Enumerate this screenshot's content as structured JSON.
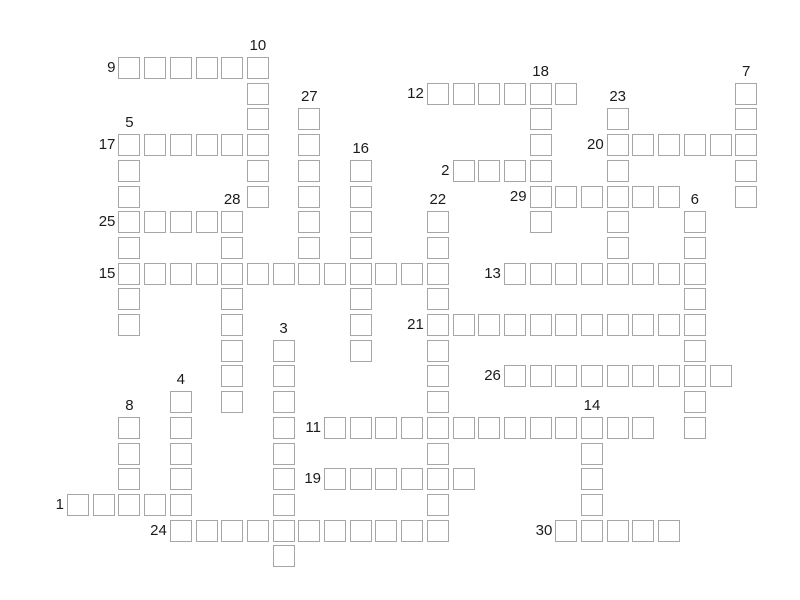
{
  "page": {
    "background_color": "#ffffff",
    "grid_line_color": "#a6a6a6",
    "number_color": "#1b1b1b"
  },
  "puzzle": {
    "type": "crossword",
    "grid": {
      "page_width": 800,
      "origin_x": 67,
      "origin_y": 57,
      "pitch": 25.7,
      "cell_outer": 22,
      "cell_fill": "#ffffff",
      "cell_border_color": "#a6a6a6"
    },
    "runs": [
      {
        "number": "1",
        "dir": "across",
        "col": 0,
        "row": 17,
        "len": 5
      },
      {
        "number": "2",
        "dir": "across",
        "col": 15,
        "row": 4,
        "len": 4
      },
      {
        "number": "3",
        "dir": "down",
        "col": 8,
        "row": 11,
        "len": 9
      },
      {
        "number": "4",
        "dir": "down",
        "col": 4,
        "row": 13,
        "len": 6
      },
      {
        "number": "5",
        "dir": "down",
        "col": 2,
        "row": 3,
        "len": 8
      },
      {
        "number": "6",
        "dir": "down",
        "col": 24,
        "row": 6,
        "len": 9
      },
      {
        "number": "7",
        "dir": "down",
        "col": 26,
        "row": 1,
        "len": 5
      },
      {
        "number": "8",
        "dir": "down",
        "col": 2,
        "row": 14,
        "len": 4
      },
      {
        "number": "9",
        "dir": "across",
        "col": 2,
        "row": 0,
        "len": 6
      },
      {
        "number": "10",
        "dir": "down",
        "col": 7,
        "row": 0,
        "len": 6
      },
      {
        "number": "11",
        "dir": "across",
        "col": 10,
        "row": 14,
        "len": 13
      },
      {
        "number": "12",
        "dir": "across",
        "col": 14,
        "row": 1,
        "len": 6
      },
      {
        "number": "13",
        "dir": "across",
        "col": 17,
        "row": 8,
        "len": 8
      },
      {
        "number": "14",
        "dir": "down",
        "col": 20,
        "row": 14,
        "len": 5
      },
      {
        "number": "15",
        "dir": "across",
        "col": 2,
        "row": 8,
        "len": 13
      },
      {
        "number": "16",
        "dir": "down",
        "col": 11,
        "row": 4,
        "len": 8
      },
      {
        "number": "17",
        "dir": "across",
        "col": 2,
        "row": 3,
        "len": 6
      },
      {
        "number": "18",
        "dir": "down",
        "col": 18,
        "row": 1,
        "len": 6
      },
      {
        "number": "19",
        "dir": "across",
        "col": 10,
        "row": 16,
        "len": 6
      },
      {
        "number": "20",
        "dir": "across",
        "col": 21,
        "row": 3,
        "len": 6
      },
      {
        "number": "21",
        "dir": "across",
        "col": 14,
        "row": 10,
        "len": 11
      },
      {
        "number": "22",
        "dir": "down",
        "col": 14,
        "row": 6,
        "len": 13
      },
      {
        "number": "23",
        "dir": "down",
        "col": 21,
        "row": 2,
        "len": 7
      },
      {
        "number": "24",
        "dir": "across",
        "col": 4,
        "row": 18,
        "len": 11
      },
      {
        "number": "25",
        "dir": "across",
        "col": 2,
        "row": 6,
        "len": 5
      },
      {
        "number": "26",
        "dir": "across",
        "col": 17,
        "row": 12,
        "len": 9
      },
      {
        "number": "27",
        "dir": "down",
        "col": 9,
        "row": 2,
        "len": 7
      },
      {
        "number": "28",
        "dir": "down",
        "col": 6,
        "row": 6,
        "len": 8
      },
      {
        "number": "29",
        "dir": "across",
        "col": 18,
        "row": 5,
        "len": 6
      },
      {
        "number": "30",
        "dir": "across",
        "col": 19,
        "row": 18,
        "len": 5
      }
    ]
  }
}
